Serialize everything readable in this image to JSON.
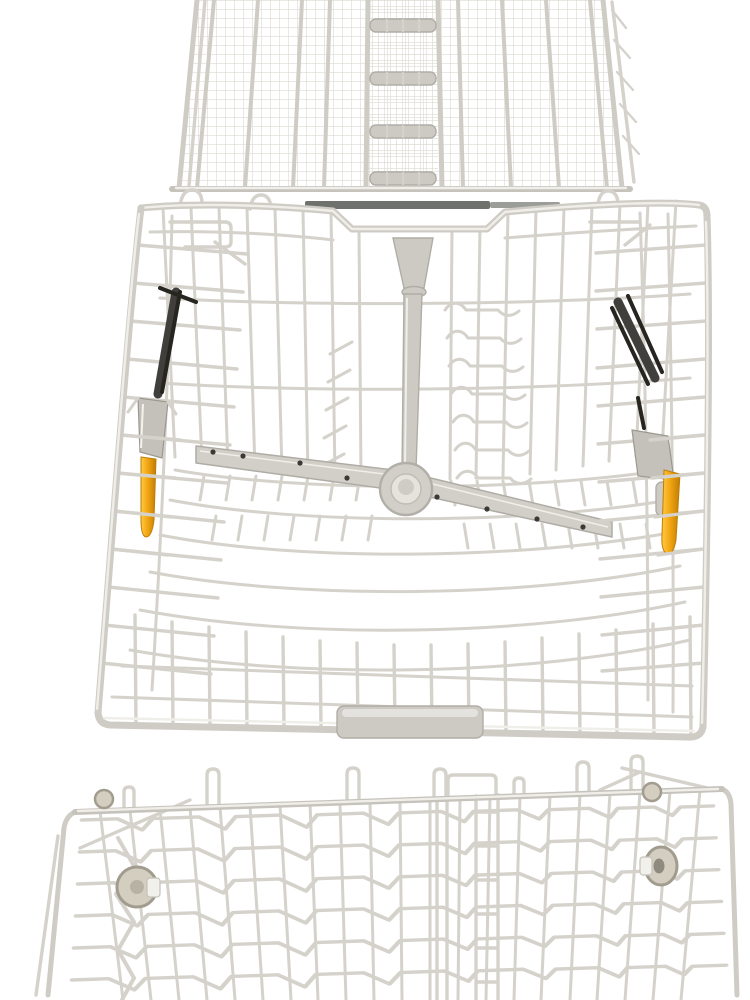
{
  "scene": {
    "type": "product-photo",
    "description": "White wire dishwasher rack set: fine-mesh cutlery tray at top, upper basket with centre spray arm, water-feed funnel and two orange height-adjustment clips, and a partially visible lower basket with grey rollers at the bottom.",
    "background": "#ffffff"
  },
  "colors": {
    "background": "#ffffff",
    "wire": "#d5d2cb",
    "wire_light": "#f0eee9",
    "frame": "#cfccc5",
    "mesh": "#dcd9d2",
    "rail_dark": "#c6c3bc",
    "plastic_gray": "#cdcac4",
    "plastic_gray_dark": "#b0ada6",
    "spray_arm": "#d2cfc8",
    "metal_dark": "#403f3b",
    "metal_black": "#26251f",
    "chrome": "#c4c1bb",
    "orange": "#f2a512",
    "orange_light": "#ffca45",
    "orange_dark": "#bf7d06",
    "wheel": "#d4cec1",
    "wheel_rim": "#a29c8f",
    "nozzle_dot": "#3a3936",
    "shadow": "#6e716c"
  }
}
